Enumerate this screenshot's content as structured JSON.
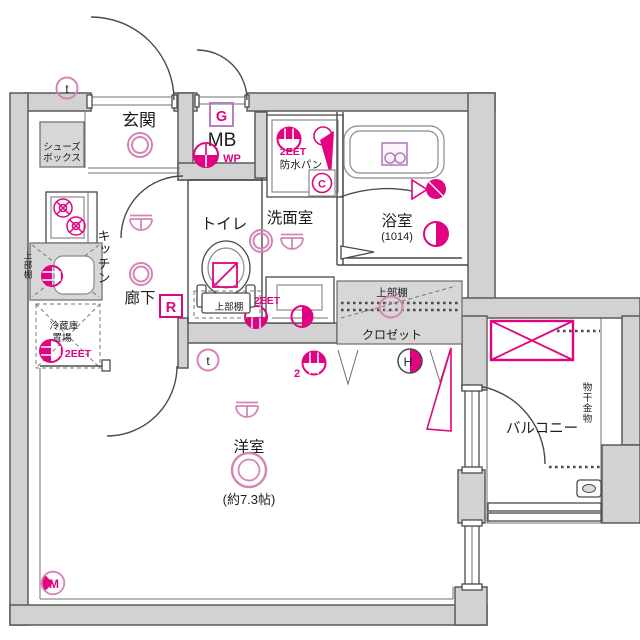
{
  "rooms": {
    "entrance": "玄関",
    "toilet": "トイレ",
    "washroom": "洗面室",
    "bathroom": "浴室",
    "bathroom_size": "(1014)",
    "kitchen": "キッチン",
    "hallway": "廊下",
    "closet": "クロゼット",
    "western_room": "洋室",
    "western_room_size": "(約7.3帖)",
    "balcony": "バルコニー"
  },
  "features": {
    "shoe_box_line1": "シューズ",
    "shoe_box_line2": "ボックス",
    "meter_box": "MB",
    "waterproof_pan": "防水パン",
    "upper_shelf_kitchen": "上部棚",
    "upper_shelf_toilet": "上部棚",
    "upper_shelf_closet": "上部棚",
    "fridge_line1": "冷蔵庫",
    "fridge_line2": "置場",
    "laundry_hardware": "物干金物"
  },
  "markers": {
    "wp": "WP",
    "gas": "G",
    "remote": "R",
    "letter_c": "C",
    "letter_h": "H",
    "letter_m": "M",
    "letter_t_top": "t",
    "letter_t_hall": "t",
    "outlet_washer": "2EET",
    "outlet_fridge": "2EET",
    "outlet_washroom": "2EET",
    "outlet_room_count": "2"
  },
  "colors": {
    "wall_fill": "#d2d2d2",
    "wall_stroke": "#5a5a5a",
    "line": "#4a4a4a",
    "magenta": "#e20380",
    "pink": "#d584b6",
    "purple": "#b57fc2",
    "text": "#1c1c1c"
  }
}
